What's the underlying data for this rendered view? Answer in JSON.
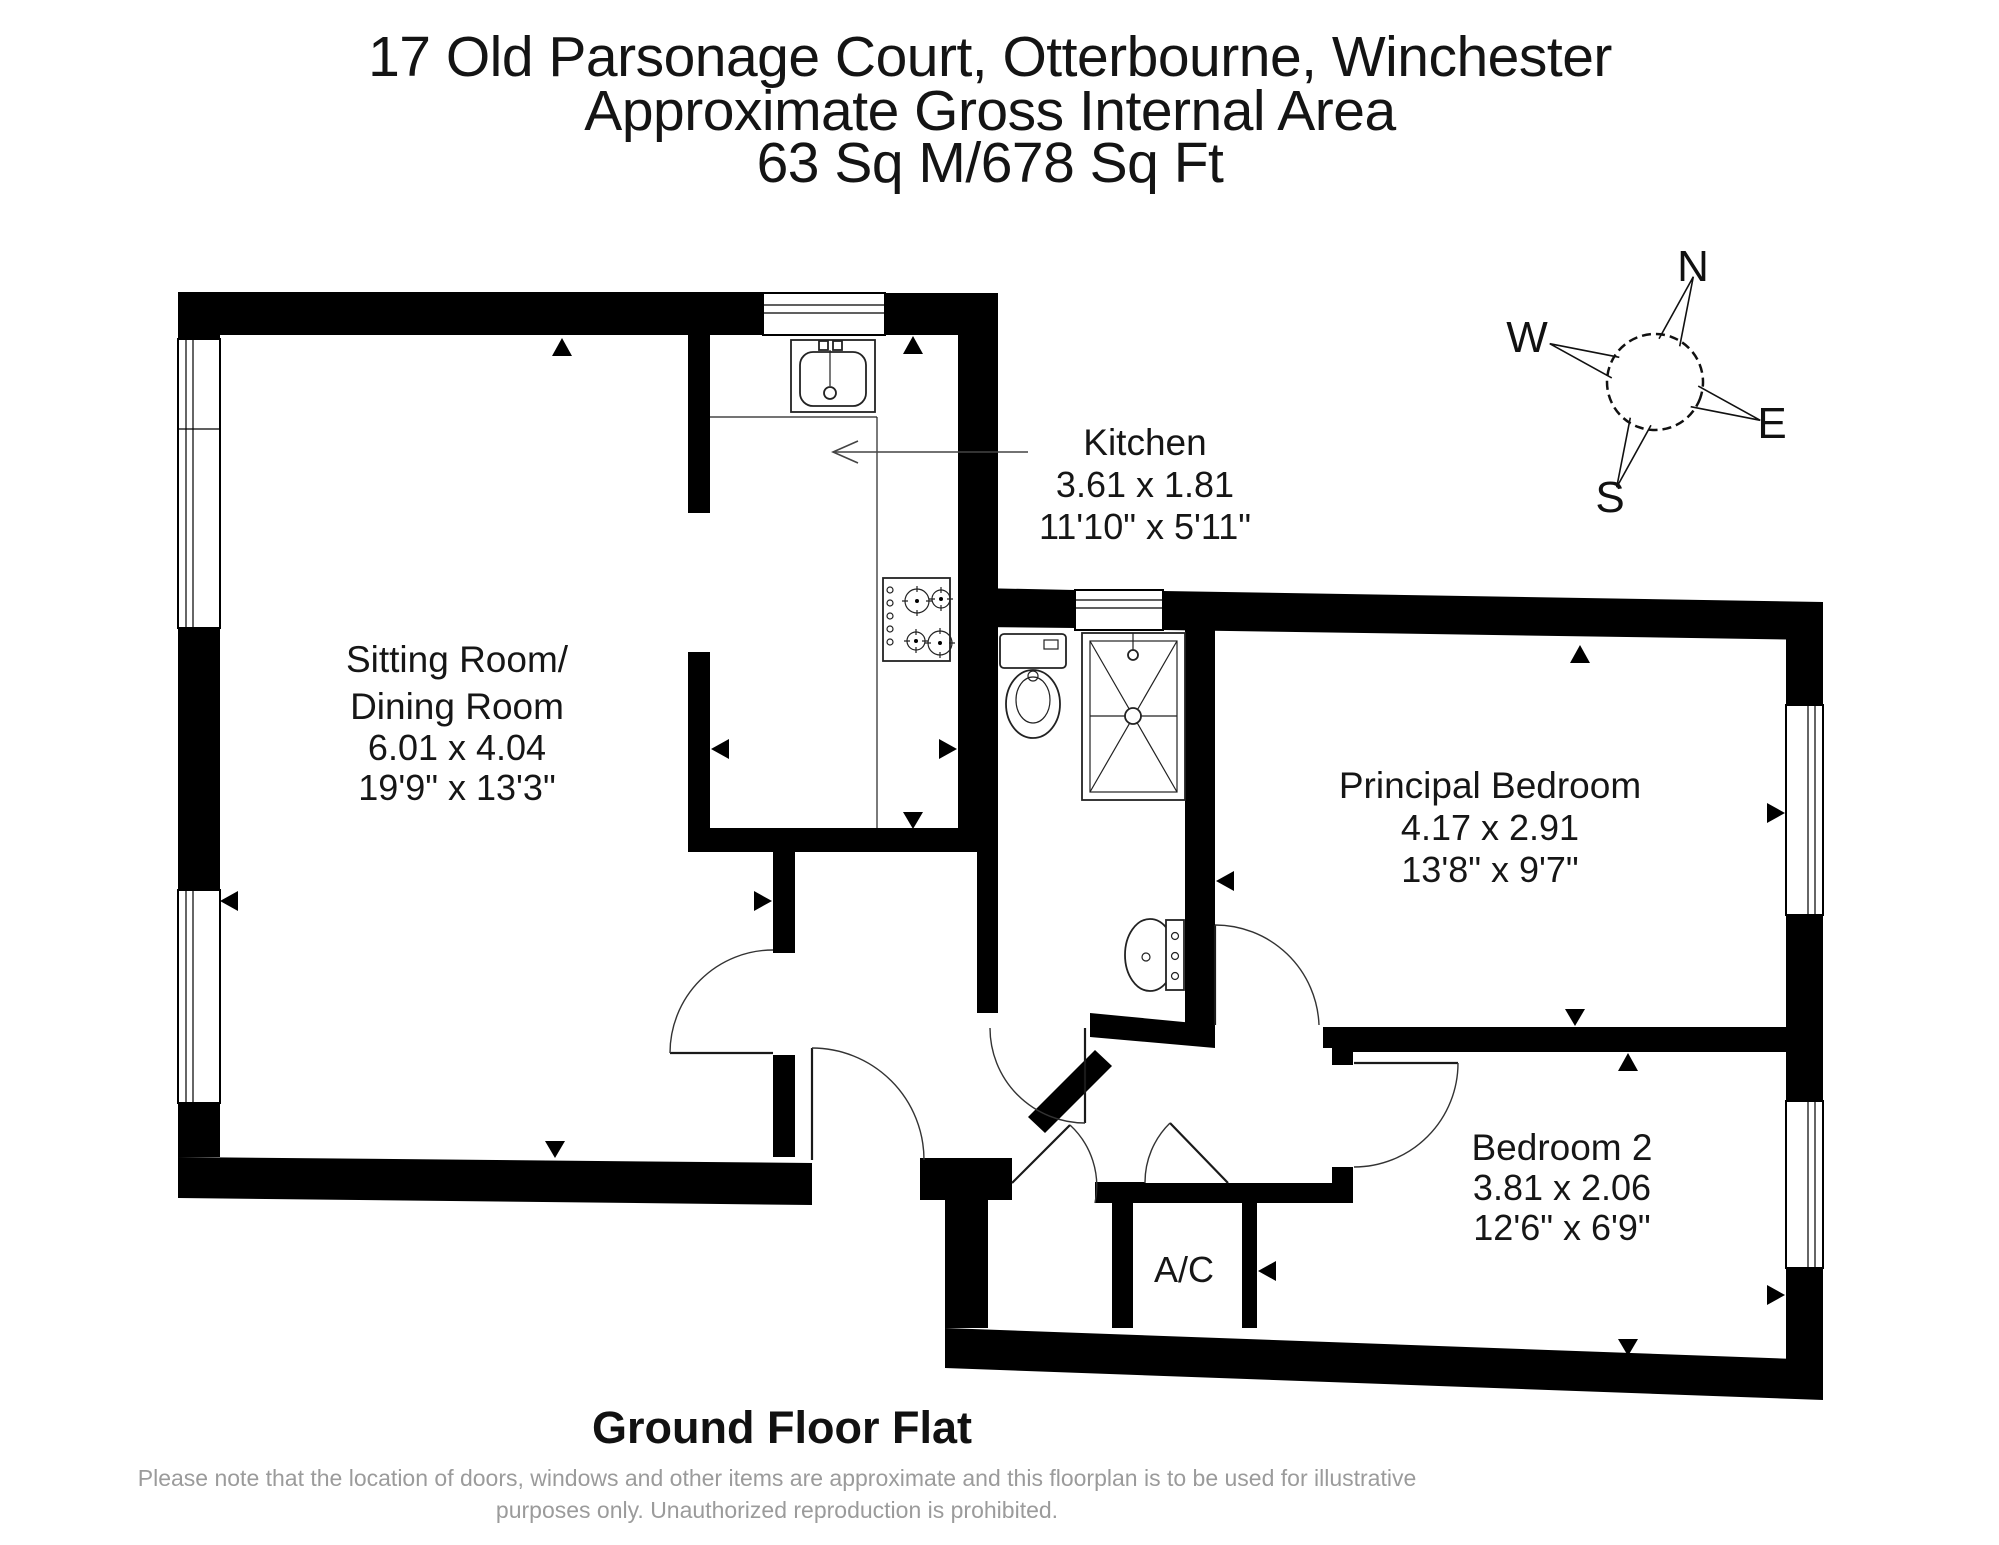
{
  "title": {
    "line1": "17 Old Parsonage Court, Otterbourne, Winchester",
    "line2": "Approximate Gross Internal Area",
    "line3": "63 Sq M/678 Sq Ft"
  },
  "compass": {
    "north": "N",
    "south": "S",
    "east": "E",
    "west": "W"
  },
  "rooms": {
    "sitting": {
      "name1": "Sitting Room/",
      "name2": "Dining Room",
      "metric": "6.01 x 4.04",
      "imperial": "19'9\" x 13'3\""
    },
    "kitchen": {
      "name": "Kitchen",
      "metric": "3.61 x 1.81",
      "imperial": "11'10\" x 5'11\""
    },
    "principal": {
      "name": "Principal Bedroom",
      "metric": "4.17 x 2.91",
      "imperial": "13'8\" x 9'7\""
    },
    "bedroom2": {
      "name": "Bedroom 2",
      "metric": "3.81 x 2.06",
      "imperial": "12'6\" x 6'9\""
    },
    "ac": {
      "name": "A/C"
    }
  },
  "footer": {
    "floor_label": "Ground Floor Flat",
    "disclaimer1": "Please note that the location of doors, windows and other items are approximate and this floorplan is to be used for illustrative",
    "disclaimer2": "purposes only. Unauthorized reproduction is prohibited."
  }
}
